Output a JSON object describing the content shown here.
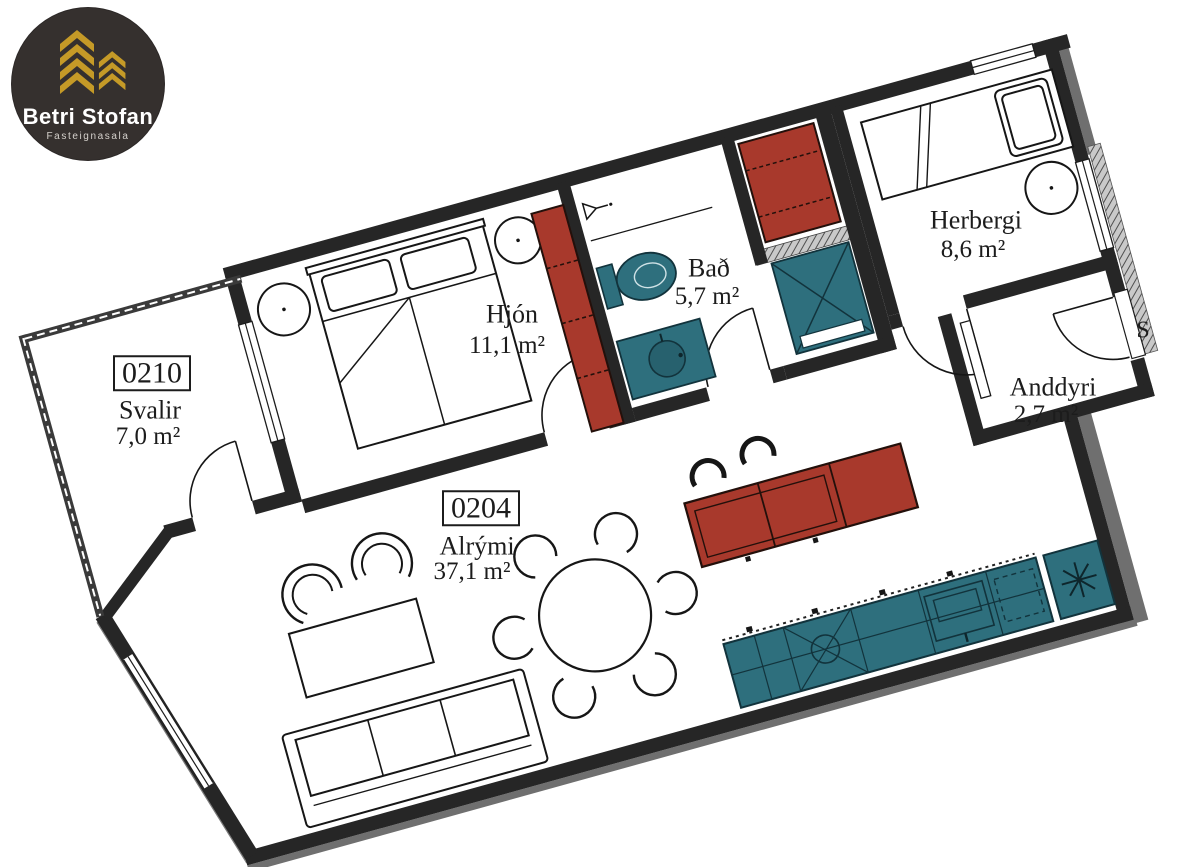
{
  "brand": {
    "name": "Betri Stofan",
    "tagline": "Fasteignasala"
  },
  "rooms": [
    {
      "unit": "0210",
      "name": "Svalir",
      "area": "7,0 m²"
    },
    {
      "name": "Hjón",
      "area": "11,1 m²"
    },
    {
      "name": "Bað",
      "area": "5,7 m²"
    },
    {
      "name": "Herbergi",
      "area": "8,6 m²"
    },
    {
      "name": "Anddyri",
      "area": "2,7 m²"
    },
    {
      "unit": "0204",
      "name": "Alrými",
      "area": "37,1 m²"
    }
  ],
  "adjacent_text": {
    "stairwell_partial": "S"
  },
  "colors": {
    "wall": "#262626",
    "furniture_red": "#A8392C",
    "furniture_teal": "#2E6F7D",
    "logo_background": "#35302e",
    "logo_gold": "#C59A27"
  }
}
